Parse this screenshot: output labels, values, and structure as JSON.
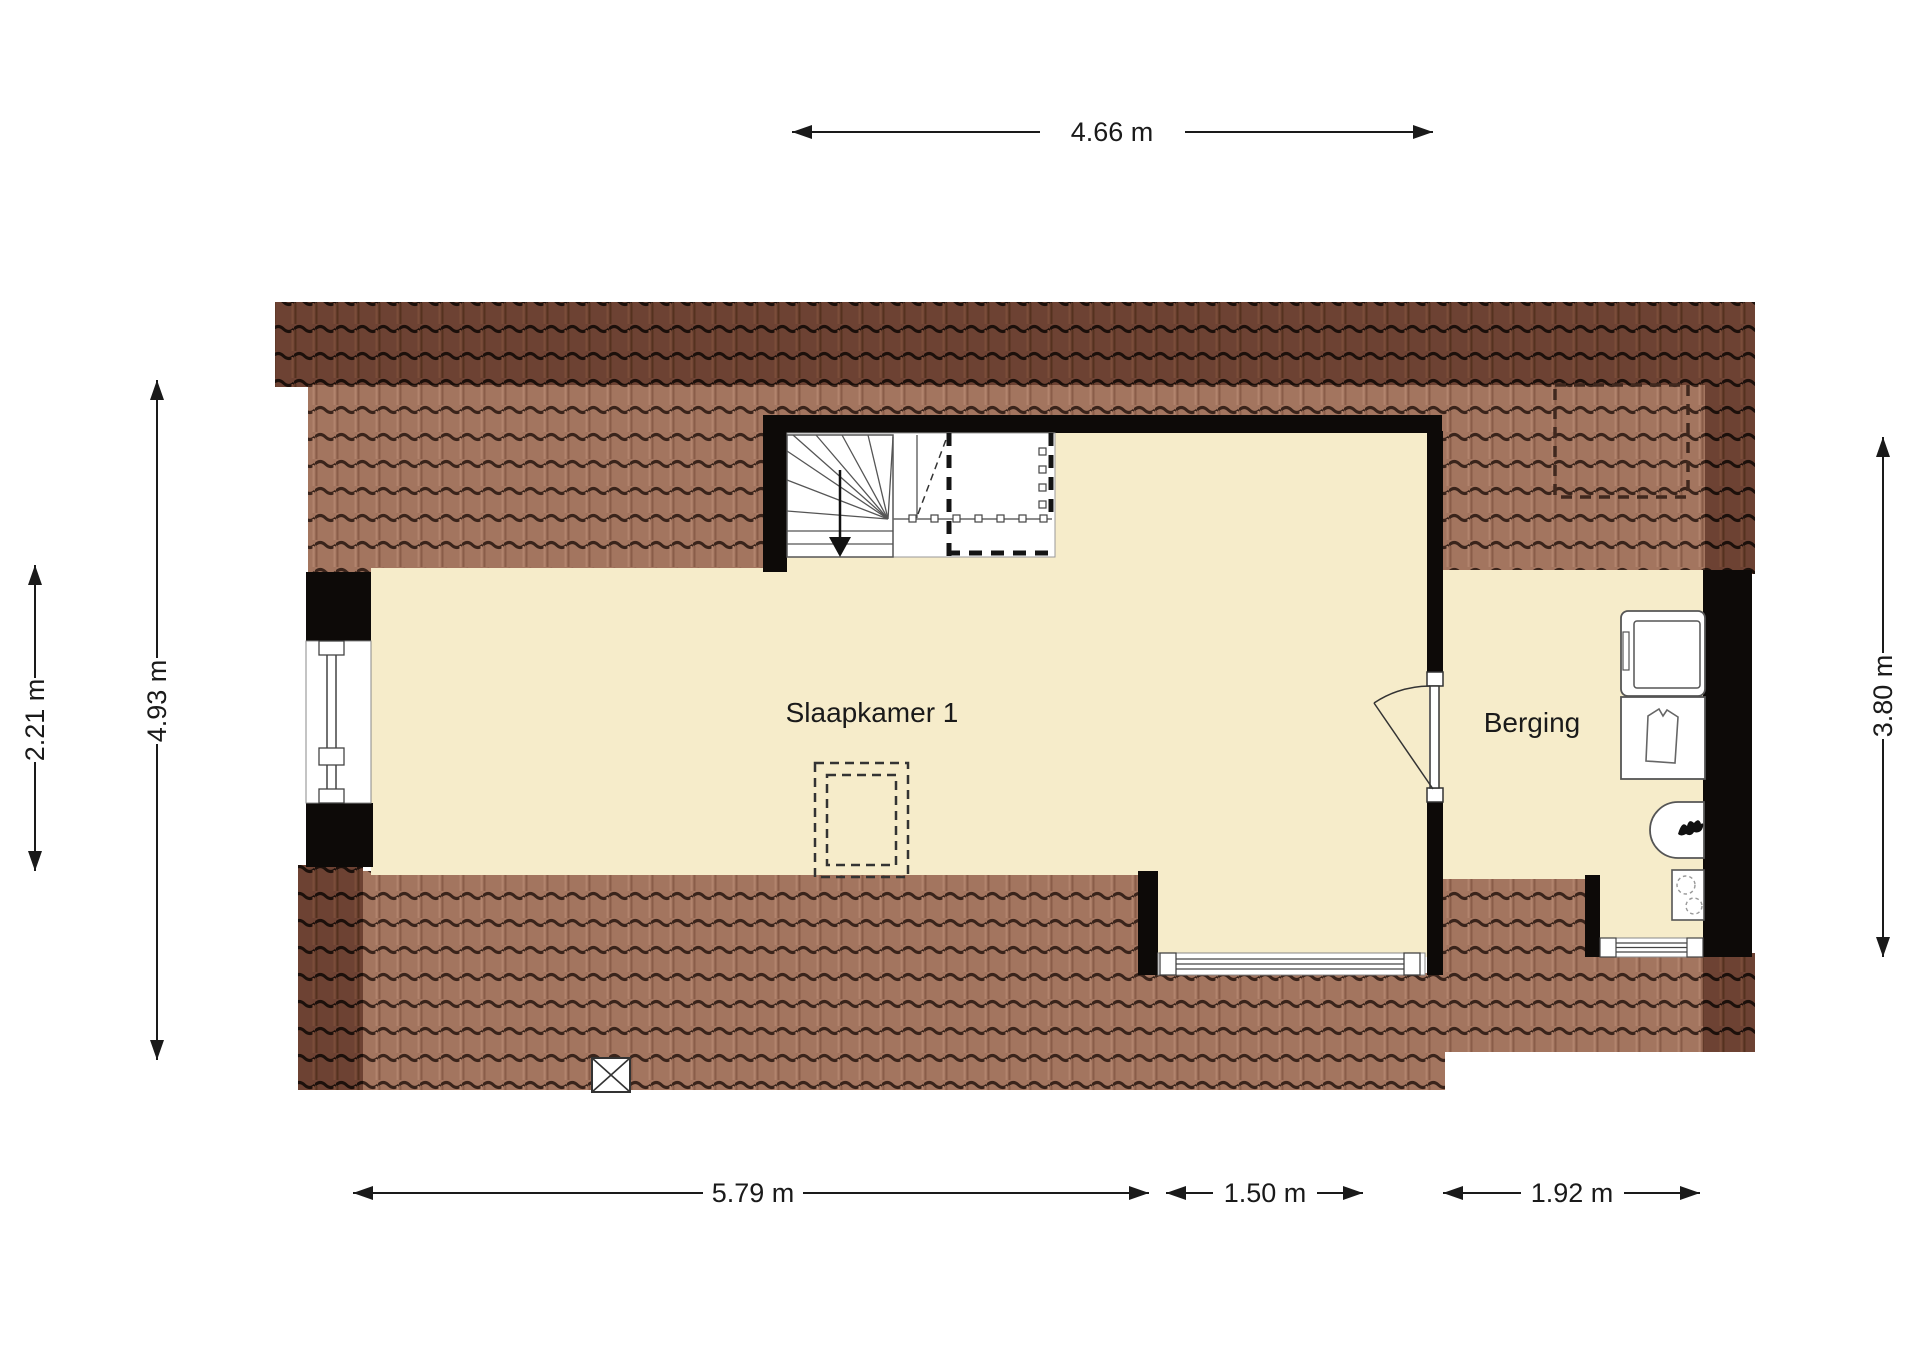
{
  "floorplan": {
    "type": "attic floor plan",
    "rooms": [
      {
        "name": "Slaapkamer 1"
      },
      {
        "name": "Berging"
      }
    ],
    "dimensions": {
      "top": "4.66 m",
      "left_outer": "2.21 m",
      "left_inner": "4.93 m",
      "right": "3.80 m",
      "bottom_left": "5.79 m",
      "bottom_middle": "1.50 m",
      "bottom_right": "1.92 m"
    },
    "symbols": [
      "staircase-with-winders",
      "stair-direction-arrow",
      "stair-opening-dashed",
      "door-with-swing",
      "window",
      "washing-machine",
      "laundry-tub",
      "boiler-with-flame",
      "hob-two-burners",
      "roof-window-dashed-outline",
      "vide-dashed-outline",
      "shaft-cross-box"
    ],
    "colors": {
      "background": "#ffffff",
      "room_fill": "#f6ecca",
      "wall": "#0d0a08",
      "roof_dark": "#6d4233",
      "roof_light": "#a3755f",
      "dimension": "#1a1a1a"
    }
  }
}
